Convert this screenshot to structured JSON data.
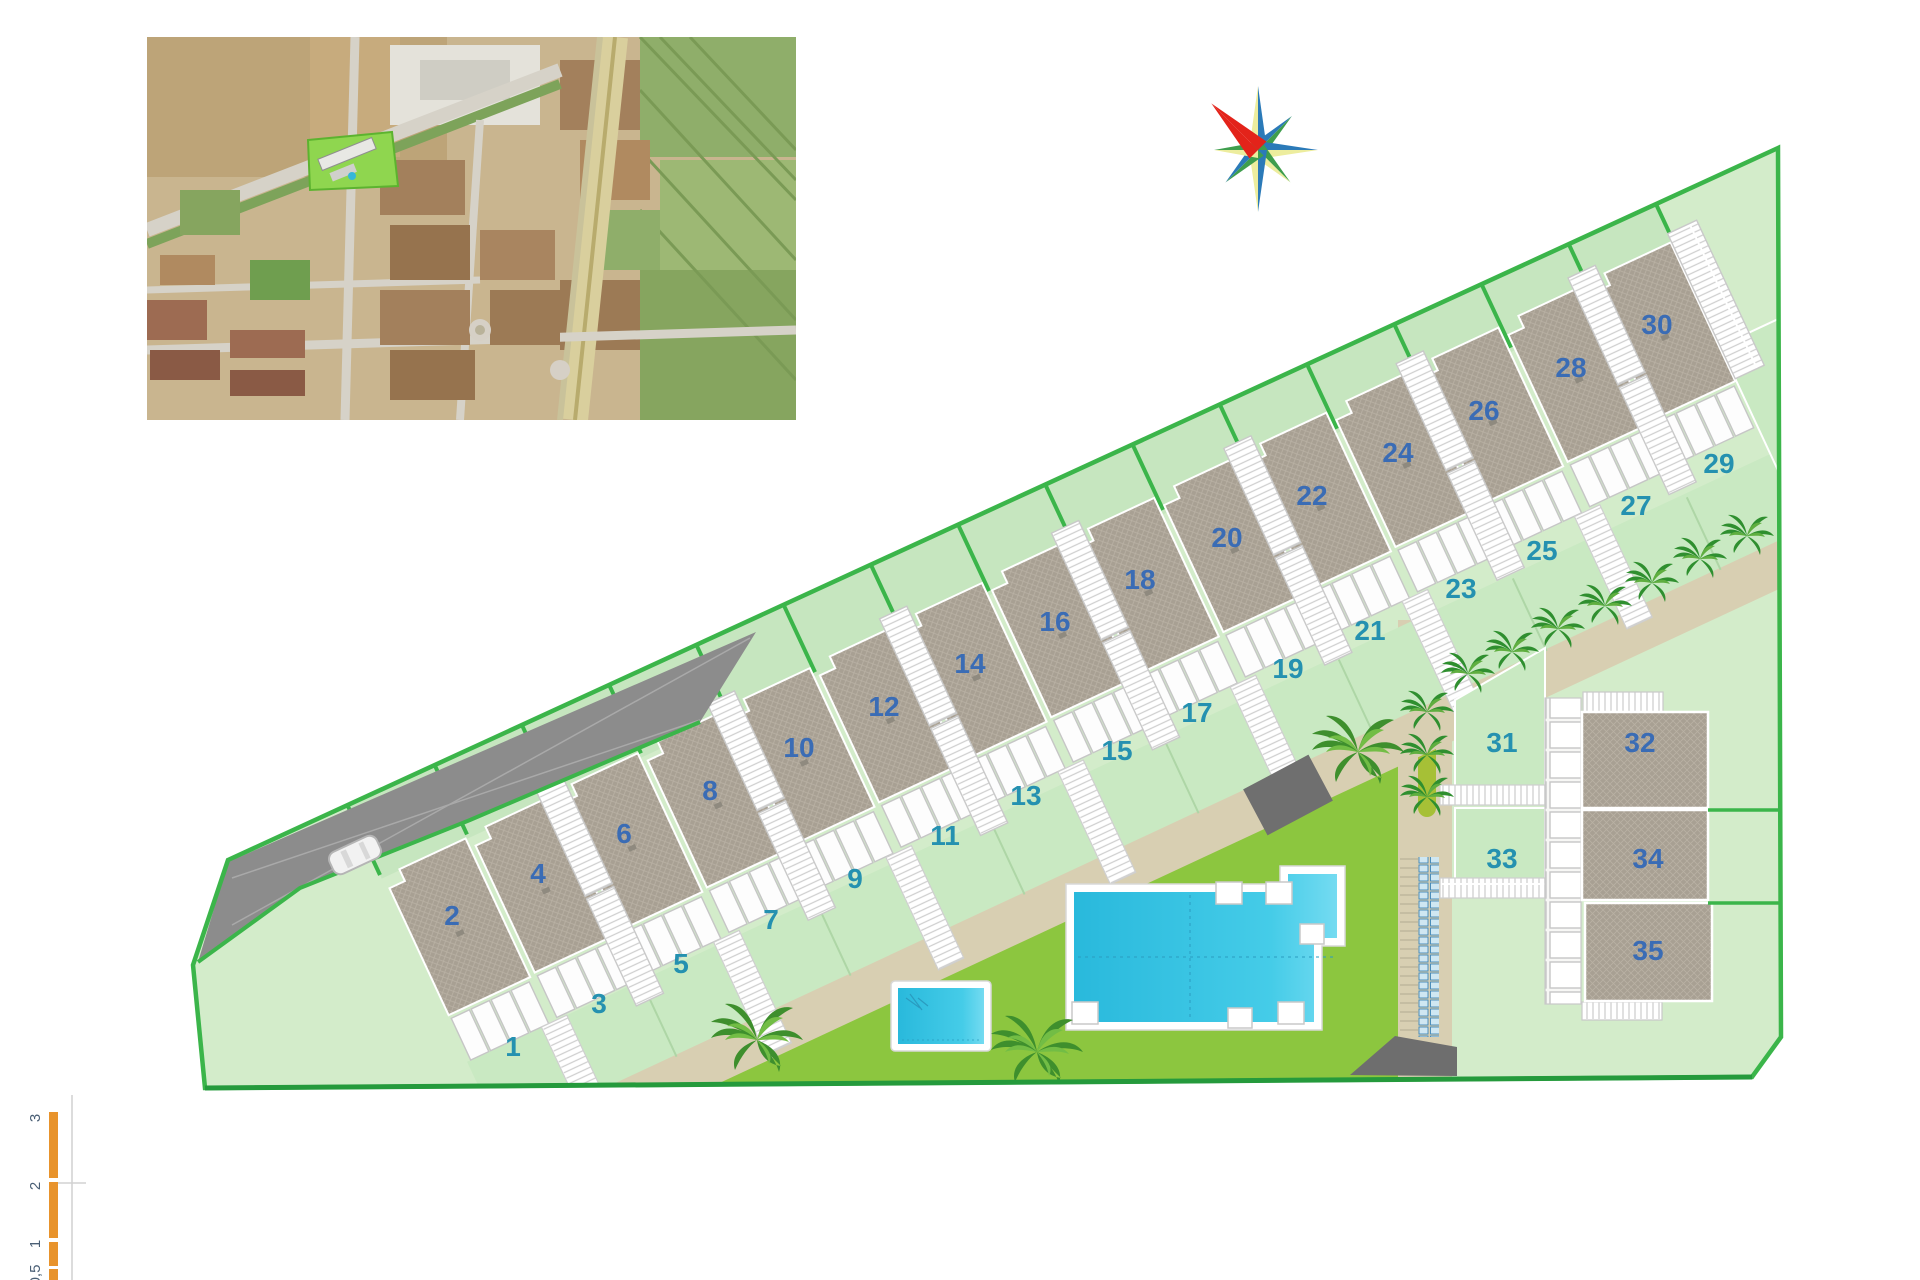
{
  "plan": {
    "title": "residential development site plan",
    "plot_labels": [
      "1",
      "2",
      "3",
      "4",
      "5",
      "6",
      "7",
      "8",
      "9",
      "10",
      "11",
      "12",
      "13",
      "14",
      "15",
      "16",
      "17",
      "18",
      "19",
      "20",
      "21",
      "22",
      "23",
      "24",
      "25",
      "26",
      "27",
      "28",
      "29",
      "30",
      "31",
      "32",
      "33",
      "34",
      "35"
    ]
  },
  "scale_bar": {
    "labels": [
      "0,5",
      "1",
      "2",
      "3"
    ]
  },
  "icons": {
    "compass_rose": "compass-rose-icon",
    "car": "car-icon",
    "palm_tree": "palm-tree-icon",
    "pool": "swimming-pool",
    "aerial_photo": "aerial-photo-inset"
  },
  "colors": {
    "boundary_green": "#3bb54a",
    "boundary_green_dark": "#259a3c",
    "interior_pale": "#d3ecca",
    "rear_garden": "#c6e6bf",
    "front_garden": "#c9e9c2",
    "roof_gray": "#a8a093",
    "driveway_gray": "#8c8c8c",
    "walkway_beige": "#d8cfb2",
    "hedge_olive": "#a6c036",
    "lawn_green": "#8cc63f",
    "pool_cyan": "#29b9dc",
    "number_blue": "#3a6cb5",
    "number_teal": "#2591b0",
    "scale_orange": "#e8932c",
    "compass_red": "#e3231a",
    "compass_blue": "#2b7ab8",
    "compass_yellow": "#eded9e",
    "compass_green": "#3f9e4d"
  }
}
